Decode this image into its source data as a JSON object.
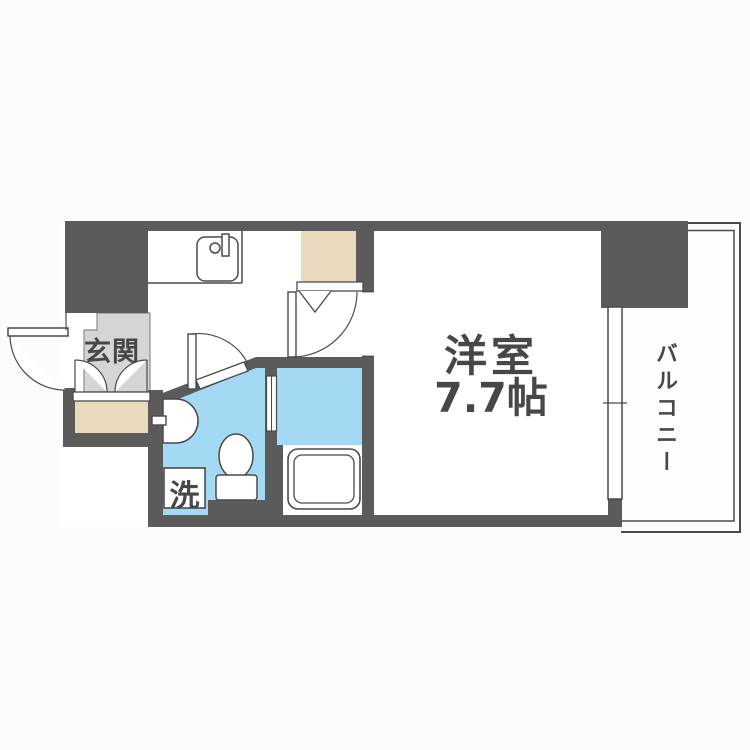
{
  "plan": {
    "type": "japanese-apartment-floorplan",
    "labels": {
      "entrance": "玄関",
      "main_room": "洋室",
      "main_room_size": "7.7帖",
      "balcony": "バルコニー",
      "laundry": "洗"
    },
    "rooms": [
      {
        "name": "genkan-entrance",
        "label": "玄関"
      },
      {
        "name": "kitchen-hallway",
        "label": ""
      },
      {
        "name": "western-room",
        "label": "洋室 7.7帖"
      },
      {
        "name": "balcony",
        "label": "バルコニー"
      },
      {
        "name": "washroom-toilet",
        "label": ""
      },
      {
        "name": "bathroom",
        "label": ""
      },
      {
        "name": "laundry-space",
        "label": "洗"
      }
    ],
    "colors": {
      "wall": "#5b5b5b",
      "line": "#4a4a4a",
      "water_area": "#a3d9f3",
      "closet": "#e9d9bd",
      "entrance_floor": "#d5d5d5",
      "background": "#fcfcfa",
      "text": "#474747"
    }
  }
}
